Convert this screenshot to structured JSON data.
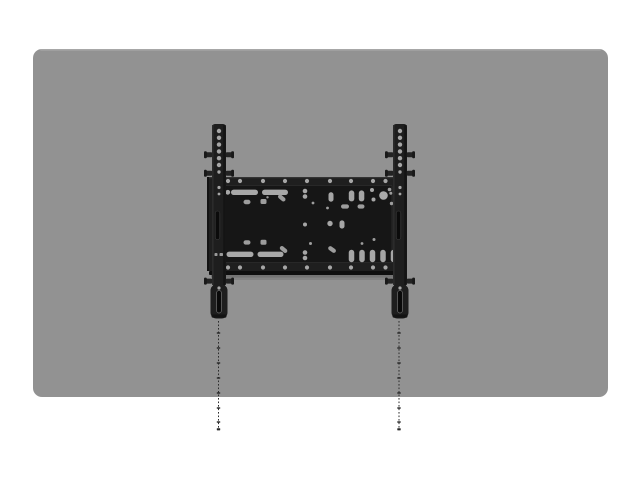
{
  "meta": {
    "description": "Product render: black fixed TV wall-mount bracket shown centered on the back of a gray flat-panel display, with dotted plumb/drill guide lines extending downward from both mounting rails.",
    "canvas": {
      "width": 640,
      "height": 480
    }
  },
  "colors": {
    "background": "#ffffff",
    "panel_gray": "#929292",
    "panel_top_highlight": "#b8b8b8",
    "bracket_black": "#1e1e1e",
    "plate_recess": "#161616",
    "slot_dark": "#0b0b0b",
    "hole_gray": "#a6a6a6",
    "guide_line": "#2d2d2d"
  },
  "scene": {
    "layers": [
      {
        "name": "display-panel",
        "shapes": [
          {
            "t": "rect",
            "x": 33,
            "y": 49,
            "w": 575,
            "h": 348,
            "rx": 9,
            "f": "#929292"
          },
          {
            "t": "rect",
            "x": 40,
            "y": 49,
            "w": 561,
            "h": 1.6,
            "rx": 0.8,
            "f": "#b8b8b8",
            "o": 0.55
          }
        ]
      },
      {
        "name": "plumb-guide-lines",
        "shapes": [
          {
            "t": "line",
            "x1": 218.5,
            "y1": 321,
            "x2": 218.5,
            "y2": 429,
            "s": "#2d2d2d",
            "sw": 1,
            "dash": "1.6 1.9"
          },
          {
            "t": "ticks",
            "x": 218.5,
            "ys": [
              333,
              348,
              363,
              378,
              393,
              408,
              422
            ],
            "w": 3.4,
            "h": 1.4,
            "f": "#262626"
          },
          {
            "t": "rect",
            "x": 216.8,
            "y": 428.2,
            "w": 3.4,
            "h": 2.2,
            "rx": 0.5,
            "f": "#262626"
          },
          {
            "t": "line",
            "x1": 399,
            "y1": 321,
            "x2": 399,
            "y2": 429,
            "s": "#2d2d2d",
            "sw": 1,
            "dash": "1.6 1.9"
          },
          {
            "t": "ticks",
            "x": 399,
            "ys": [
              333,
              348,
              363,
              378,
              393,
              408,
              422
            ],
            "w": 3.4,
            "h": 1.4,
            "f": "#262626"
          },
          {
            "t": "rect",
            "x": 397.3,
            "y": 428.2,
            "w": 3.4,
            "h": 2.2,
            "rx": 0.5,
            "f": "#262626"
          }
        ]
      },
      {
        "name": "wall-plate",
        "shapes": [
          {
            "t": "rect",
            "x": 207,
            "y": 177,
            "w": 198,
            "h": 94,
            "rx": 1.5,
            "f": "#1f1f1f"
          },
          {
            "t": "rect",
            "x": 207,
            "y": 177,
            "w": 198,
            "h": 1.3,
            "f": "#3c3c3c",
            "o": 0.7
          },
          {
            "t": "rect",
            "x": 207,
            "y": 177,
            "w": 2,
            "h": 94,
            "f": "#121212"
          },
          {
            "t": "rect",
            "x": 403,
            "y": 177,
            "w": 2,
            "h": 94,
            "f": "#121212"
          },
          {
            "t": "rect",
            "x": 218,
            "y": 185.5,
            "w": 174,
            "h": 77,
            "rx": 1,
            "f": "#161616",
            "s": "#2e2e2e",
            "sw": 0.8
          },
          {
            "t": "rect",
            "x": 209,
            "y": 271,
            "w": 198,
            "h": 4,
            "rx": 1,
            "f": "#0f0f0f"
          },
          {
            "t": "rect",
            "x": 211,
            "y": 275,
            "w": 194,
            "h": 2.6,
            "f": "#000000",
            "o": 0.2
          },
          {
            "t": "rect",
            "x": 213,
            "y": 277.6,
            "w": 190,
            "h": 2.4,
            "f": "#000000",
            "o": 0.09
          },
          {
            "t": "crow",
            "y": 181,
            "r": 2.1,
            "f": "#a6a6a6",
            "xs": [
              228,
              240,
              263,
              285,
              307,
              330,
              351,
              373,
              385.5
            ]
          },
          {
            "t": "crow",
            "y": 267.5,
            "r": 2.1,
            "f": "#a6a6a6",
            "xs": [
              228,
              240,
              263,
              285,
              307,
              330,
              351,
              373,
              385.5
            ]
          },
          {
            "t": "rect",
            "x": 231,
            "y": 189.6,
            "w": 27,
            "h": 5.4,
            "rx": 2.7,
            "f": "#a8a8a8"
          },
          {
            "t": "rect",
            "x": 262,
            "y": 189.6,
            "w": 26,
            "h": 5.4,
            "rx": 2.7,
            "f": "#a8a8a8"
          },
          {
            "t": "circle",
            "cx": 227.8,
            "cy": 192.3,
            "r": 2.4,
            "f": "#a6a6a6"
          },
          {
            "t": "rect",
            "x": 226.5,
            "y": 251.6,
            "w": 27,
            "h": 5.4,
            "rx": 2.7,
            "f": "#a8a8a8"
          },
          {
            "t": "rect",
            "x": 257.5,
            "y": 251.6,
            "w": 26,
            "h": 5.4,
            "rx": 2.7,
            "f": "#a8a8a8"
          },
          {
            "t": "rect",
            "x": 243.5,
            "y": 199.8,
            "w": 7,
            "h": 4.4,
            "rx": 2.2,
            "f": "#9d9d9d"
          },
          {
            "t": "rect",
            "x": 260.5,
            "y": 199,
            "w": 6,
            "h": 5,
            "rx": 1.5,
            "f": "#9d9d9d"
          },
          {
            "t": "circle",
            "cx": 267.5,
            "cy": 197.3,
            "r": 1.2,
            "f": "#9d9d9d"
          },
          {
            "t": "rect",
            "x": 243.5,
            "y": 240.2,
            "w": 7,
            "h": 4.4,
            "rx": 2.2,
            "f": "#9d9d9d"
          },
          {
            "t": "rect",
            "x": 260.5,
            "y": 239.8,
            "w": 6,
            "h": 5,
            "rx": 1.5,
            "f": "#9d9d9d"
          },
          {
            "t": "rect",
            "x": 277.5,
            "y": 195.9,
            "w": 8.5,
            "h": 4.2,
            "rx": 2.1,
            "rot": 40,
            "f": "#9d9d9d"
          },
          {
            "t": "rect",
            "x": 279.3,
            "y": 247.4,
            "w": 8.5,
            "h": 4.2,
            "rx": 2.1,
            "rot": 40,
            "f": "#9d9d9d"
          },
          {
            "t": "circle",
            "cx": 305,
            "cy": 191,
            "r": 2.3,
            "f": "#a6a6a6"
          },
          {
            "t": "circle",
            "cx": 305,
            "cy": 196.5,
            "r": 2.3,
            "f": "#a6a6a6"
          },
          {
            "t": "circle",
            "cx": 305,
            "cy": 252.5,
            "r": 2.3,
            "f": "#a6a6a6"
          },
          {
            "t": "circle",
            "cx": 305,
            "cy": 258,
            "r": 2.3,
            "f": "#a6a6a6"
          },
          {
            "t": "circle",
            "cx": 313,
            "cy": 203,
            "r": 1.4,
            "f": "#9d9d9d"
          },
          {
            "t": "circle",
            "cx": 310.5,
            "cy": 243.5,
            "r": 1.5,
            "f": "#9d9d9d"
          },
          {
            "t": "circle",
            "cx": 327.5,
            "cy": 208,
            "r": 1.4,
            "f": "#9d9d9d"
          },
          {
            "t": "rect",
            "x": 328.5,
            "y": 192.3,
            "w": 5,
            "h": 9.4,
            "rx": 2.5,
            "f": "#a6a6a6"
          },
          {
            "t": "rect",
            "x": 327.8,
            "y": 247.4,
            "w": 8.5,
            "h": 4.2,
            "rx": 2.1,
            "rot": 35,
            "f": "#9d9d9d"
          },
          {
            "t": "circle",
            "cx": 305,
            "cy": 224.5,
            "r": 2,
            "f": "#a6a6a6"
          },
          {
            "t": "circle",
            "cx": 330,
            "cy": 223.5,
            "r": 2.7,
            "f": "#a6a6a6"
          },
          {
            "t": "rect",
            "x": 339.5,
            "y": 220.4,
            "w": 5,
            "h": 8.2,
            "rx": 2.5,
            "f": "#a6a6a6"
          },
          {
            "t": "rect",
            "x": 341,
            "y": 204.4,
            "w": 8,
            "h": 4.2,
            "rx": 2.1,
            "f": "#9d9d9d"
          },
          {
            "t": "rect",
            "x": 357.5,
            "y": 204.4,
            "w": 7,
            "h": 4.2,
            "rx": 2.1,
            "f": "#9d9d9d"
          },
          {
            "t": "rect",
            "x": 348.8,
            "y": 190.4,
            "w": 5.5,
            "h": 11,
            "rx": 2.7,
            "f": "#a6a6a6"
          },
          {
            "t": "rect",
            "x": 358.8,
            "y": 190.4,
            "w": 5.5,
            "h": 11,
            "rx": 2.7,
            "f": "#a6a6a6"
          },
          {
            "t": "circle",
            "cx": 372,
            "cy": 190,
            "r": 2,
            "f": "#a6a6a6"
          },
          {
            "t": "circle",
            "cx": 373.5,
            "cy": 199.5,
            "r": 2,
            "f": "#a6a6a6"
          },
          {
            "t": "circle",
            "cx": 383.5,
            "cy": 195.5,
            "r": 4.3,
            "f": "#aaaaaa"
          },
          {
            "t": "circle",
            "cx": 389.5,
            "cy": 189.5,
            "r": 1.8,
            "f": "#9d9d9d"
          },
          {
            "t": "circle",
            "cx": 391.5,
            "cy": 203.5,
            "r": 1.7,
            "f": "#9d9d9d"
          },
          {
            "t": "circle",
            "cx": 390.8,
            "cy": 193.2,
            "r": 1.5,
            "f": "#9d9d9d"
          },
          {
            "t": "circle",
            "cx": 362,
            "cy": 243.5,
            "r": 1.4,
            "f": "#9d9d9d"
          },
          {
            "t": "circle",
            "cx": 374,
            "cy": 239.5,
            "r": 1.5,
            "f": "#9d9d9d"
          },
          {
            "t": "orow",
            "y": 249.8,
            "w": 5.5,
            "h": 12.4,
            "rx": 2.75,
            "f": "#a6a6a6",
            "xs": [
              351.5,
              362,
              372.5,
              383,
              393.5
            ]
          }
        ]
      },
      {
        "name": "left-rail",
        "shapes": [
          {
            "t": "rect",
            "x": 212,
            "y": 124,
            "w": 14,
            "h": 162,
            "rx": 3,
            "f": "#1e1e1e"
          },
          {
            "t": "rect",
            "x": 223.2,
            "y": 125,
            "w": 2.6,
            "h": 160,
            "f": "#131313",
            "o": 0.9
          },
          {
            "t": "rect",
            "x": 212,
            "y": 125,
            "w": 1.6,
            "h": 160,
            "f": "#2c2c2c",
            "o": 0.9
          },
          {
            "t": "tabs",
            "cx": 219,
            "ys": [
              152.2,
              170.8,
              278.6
            ]
          },
          {
            "t": "rect",
            "x": 210.5,
            "y": 284.5,
            "w": 17,
            "h": 34,
            "rx": 6,
            "f": "#1e1e1e"
          },
          {
            "t": "rect",
            "x": 211.5,
            "y": 314.5,
            "w": 15,
            "h": 3.2,
            "rx": 1.5,
            "f": "#121212",
            "o": 0.85
          },
          {
            "t": "rect",
            "x": 216.6,
            "y": 290.5,
            "w": 4.8,
            "h": 22.5,
            "rx": 2.4,
            "f": "#0a0a0a",
            "s": "#6e6e6e",
            "sw": 0.7
          },
          {
            "t": "rect",
            "x": 215.2,
            "y": 211,
            "w": 4.6,
            "h": 28.5,
            "rx": 2.3,
            "f": "#0b0b0b",
            "s": "#404040",
            "sw": 0.6
          },
          {
            "t": "ccol",
            "x": 219,
            "items": [
              [
                131,
                2.2
              ],
              [
                137.8,
                2.2
              ],
              [
                144.6,
                2.2
              ],
              [
                151.4,
                2.2
              ],
              [
                158.2,
                2.2
              ],
              [
                165,
                2.2
              ],
              [
                172,
                1.7
              ],
              [
                187.5,
                1.6
              ],
              [
                194,
                1.4
              ],
              [
                288,
                1.6
              ]
            ],
            "f": "#a6a6a6"
          },
          {
            "t": "rect",
            "x": 214.5,
            "y": 253,
            "w": 3,
            "h": 3,
            "rx": 0.8,
            "f": "#9a9a9a"
          },
          {
            "t": "rect",
            "x": 219.5,
            "y": 253,
            "w": 3.5,
            "h": 3,
            "rx": 0.8,
            "f": "#9a9a9a"
          }
        ]
      },
      {
        "name": "right-rail",
        "shapes": [
          {
            "t": "rect",
            "x": 393,
            "y": 124,
            "w": 14,
            "h": 162,
            "rx": 3,
            "f": "#1e1e1e"
          },
          {
            "t": "rect",
            "x": 404.2,
            "y": 125,
            "w": 2.6,
            "h": 160,
            "f": "#131313",
            "o": 0.9
          },
          {
            "t": "rect",
            "x": 393,
            "y": 125,
            "w": 1.6,
            "h": 160,
            "f": "#2c2c2c",
            "o": 0.9
          },
          {
            "t": "tabs",
            "cx": 400,
            "ys": [
              152.2,
              170.8,
              278.6
            ]
          },
          {
            "t": "rect",
            "x": 391.5,
            "y": 284.5,
            "w": 17,
            "h": 34,
            "rx": 6,
            "f": "#1e1e1e"
          },
          {
            "t": "rect",
            "x": 392.5,
            "y": 314.5,
            "w": 15,
            "h": 3.2,
            "rx": 1.5,
            "f": "#121212",
            "o": 0.85
          },
          {
            "t": "rect",
            "x": 397.6,
            "y": 290.5,
            "w": 4.8,
            "h": 22.5,
            "rx": 2.4,
            "f": "#0a0a0a",
            "s": "#6e6e6e",
            "sw": 0.7
          },
          {
            "t": "rect",
            "x": 396.2,
            "y": 211,
            "w": 4.6,
            "h": 28.5,
            "rx": 2.3,
            "f": "#0b0b0b",
            "s": "#404040",
            "sw": 0.6
          },
          {
            "t": "ccol",
            "x": 400,
            "items": [
              [
                131,
                2.2
              ],
              [
                137.8,
                2.2
              ],
              [
                144.6,
                2.2
              ],
              [
                151.4,
                2.2
              ],
              [
                158.2,
                2.2
              ],
              [
                165,
                2.2
              ],
              [
                172,
                1.7
              ],
              [
                187.5,
                1.6
              ],
              [
                194,
                1.4
              ],
              [
                288,
                1.6
              ]
            ],
            "f": "#a6a6a6"
          }
        ]
      }
    ]
  }
}
